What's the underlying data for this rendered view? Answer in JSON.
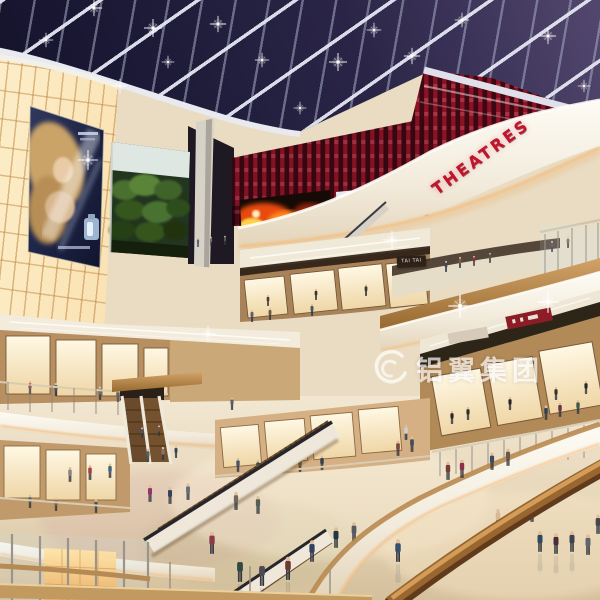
{
  "meta": {
    "type": "architectural-rendering",
    "subject": "multi-level shopping mall atrium interior at night",
    "features": "night skylight grid, cinema level with red wall, glowing lantern wall with perfume billboard, curved white balconies, escalators, crowds on marble floor"
  },
  "signs": {
    "theatres": "THEATRES",
    "shop_sign": "TAI TAI",
    "watermark": "铝翼集团"
  },
  "palette": {
    "sky": "#1c1834",
    "accent_red": "#c81a30",
    "warm_panel": "#f5d49a",
    "wood": "#b9854e",
    "fascia_white": "#f7f2e8",
    "floor": "#e9dcc3"
  }
}
